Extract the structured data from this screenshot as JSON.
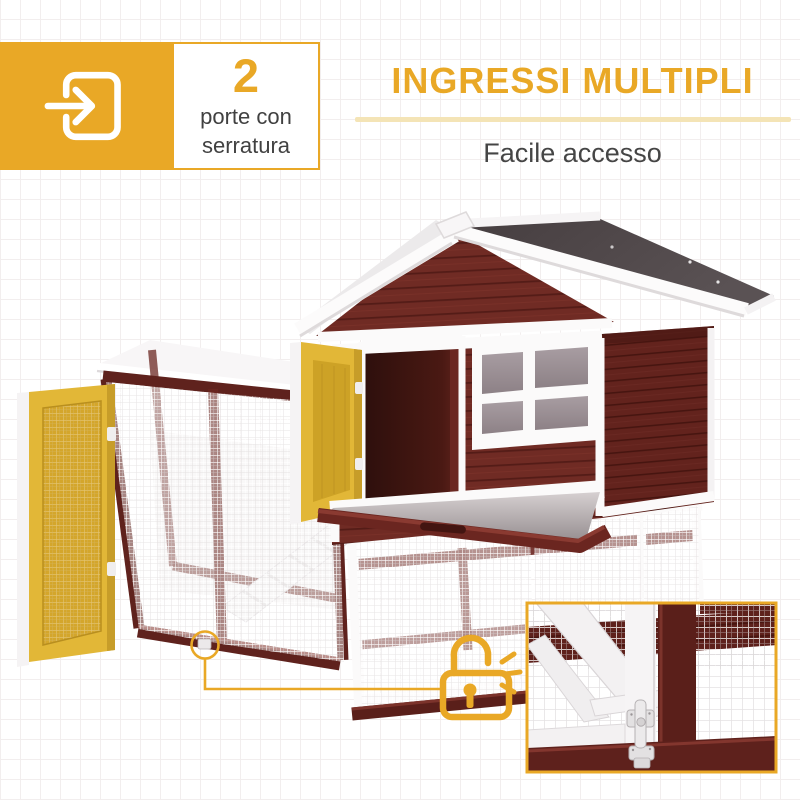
{
  "badge": {
    "number": "2",
    "label_line1": "porte con",
    "label_line2": "serratura",
    "icon": "door-entry-arrow-icon"
  },
  "header": {
    "title": "INGRESSI MULTIPLI",
    "subtitle": "Facile accesso"
  },
  "callout": {
    "icon": "open-padlock-icon",
    "target": "run-door-latch",
    "inset": "latch-detail-closeup"
  },
  "colors": {
    "accent_gold": "#e9a826",
    "underline": "#f4e4b6",
    "text_dark": "#454545",
    "label_gray": "#414141",
    "wood_red": "#6e2a24",
    "wood_red_dark": "#5a1f1a",
    "roof_gray": "#4e4647",
    "door_yellow": "#e2b737",
    "door_yellow_inner": "#d4a62b",
    "trim_white": "#fbfafa",
    "window_pane": "#9a8e93",
    "grid_line": "#f2eeee"
  }
}
